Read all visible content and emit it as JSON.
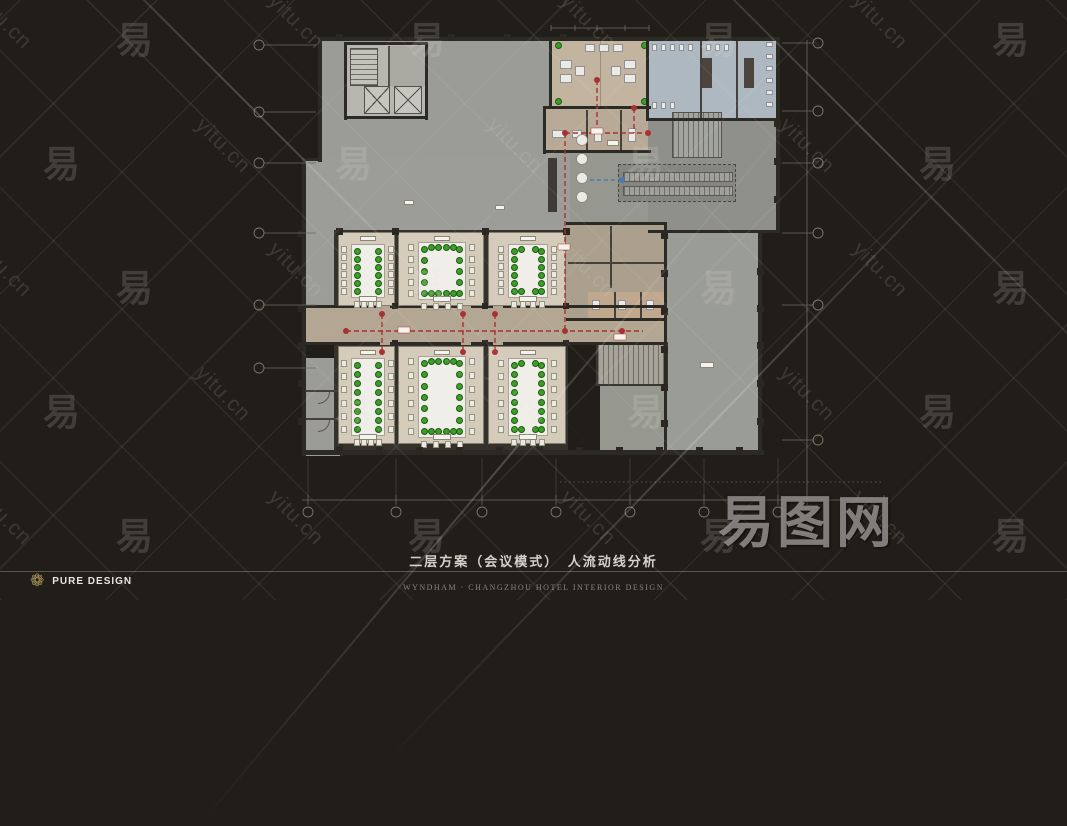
{
  "title": {
    "text": "二层方案（会议模式）　人流动线分析"
  },
  "footer": {
    "brand": "PURE DESIGN",
    "brand_icon": "flower-rosette",
    "credit": "WYNDHAM · CHANGZHOU HOTEL INTERIOR DESIGN"
  },
  "watermark": {
    "site": "yitu.cn",
    "char": "易",
    "logo": "易图网"
  },
  "colors": {
    "background": "#211d18",
    "flow_red": "#a83232",
    "flow_blue": "#4a7ab0",
    "chair_green": "#3c9e28",
    "brand_gold": "#ab9459",
    "meeting_room_floor": "#d4cbba",
    "corridor_floor": "#b3a793",
    "restroom_floor": "#adb8c0"
  }
}
